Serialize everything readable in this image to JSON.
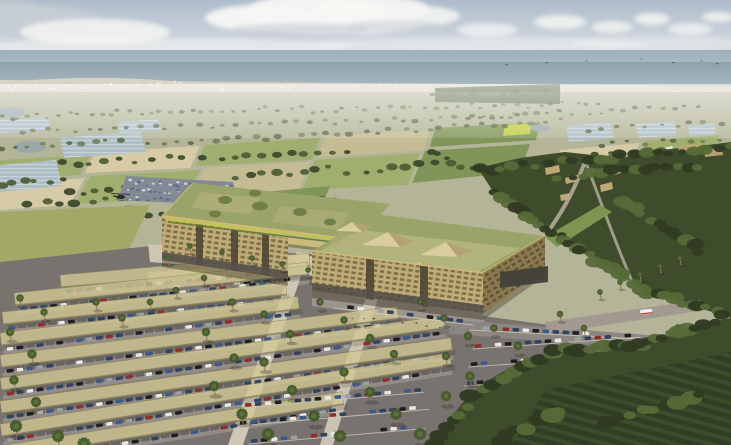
{
  "scene": {
    "type": "aerial-architectural-rendering",
    "description": "Bird's-eye rendering of a coastal campus: two long timber-screened buildings with green meadow roofs and glass pyramid skylights, a pergola-linked entrance plaza, fan-shaped solar-canopy parking lots filled with cars and palm trees, farmland patchwork with greenhouses and ponds, a village among dense trees, orchards in the foreground, a white coastal town strip and the sea under a hazy cloudy sky; a small helicopter flies over the fields.",
    "elements": [
      "sky-with-clouds",
      "sea-horizon",
      "ships",
      "coastal-town-strip",
      "farmland-patchwork",
      "greenhouses",
      "ponds",
      "distant-parking-lot",
      "helicopter",
      "village-in-trees",
      "right-forest",
      "main-building-left-wing",
      "main-building-right-wing",
      "green-roofs",
      "rooftop-trees",
      "skylight-pyramids",
      "entrance-pergola",
      "entrance-plaza",
      "solar-canopy-parking",
      "parked-cars",
      "open-parking-rows",
      "walkways",
      "access-roads",
      "truck",
      "palm-trees",
      "bottom-forest-orchard"
    ]
  },
  "colors": {
    "skyTop": "#aebccb",
    "skyMid": "#d7dce1",
    "skyHorizon": "#eef0ed",
    "cloudWhite": "#f7f7f4",
    "cloudGray": "#c7cdd4",
    "seaFar": "#7f96a4",
    "seaNear": "#aebcc3",
    "shipDark": "#5a6670",
    "coastStrip": "#d8d3c5",
    "coastCity": "#f2efe6",
    "plainBase": "#b4b598",
    "fieldTan": "#c8bd94",
    "fieldTanLight": "#d8cda6",
    "fieldGreen": "#9fae6d",
    "fieldGreenDark": "#7e9455",
    "fieldYellow": "#c3cf3e",
    "pond": "#9aa8a8",
    "greenhouse": "#aebfc6",
    "greenhouseRidge": "#e8eef0",
    "treeFar": "#6d7b52",
    "treeFarDark": "#556440",
    "treeMid": "#4c5b34",
    "treeMidDark": "#39462a",
    "forest": "#3f4c2c",
    "forestLight": "#566a38",
    "forestDark": "#2f3a22",
    "villageWall": "#c0a876",
    "facade": "#bda972",
    "facadeShade": "#9d8a5a",
    "windowDark": "#6d5f42",
    "recess": "#4e4634",
    "groundFloor": "#56514a",
    "fascia": "#cdb97a",
    "roofMeadow": "#9aa468",
    "roofMeadowLight": "#b5b07c",
    "roofTree": "#717f48",
    "flowerYellow": "#c5c44e",
    "flowerGreen": "#5f7a3c",
    "pyramidLight": "#d9cc9e",
    "pyramidShade": "#b5a273",
    "trellis": "#d8cf9e",
    "asphalt": "#797370",
    "aisle": "#8d8784",
    "stallConcrete": "#cfc8ba",
    "walkway": "#d8d0bd",
    "plaza": "#cfc6b2",
    "roadLight": "#a29a90",
    "canopy": "#d1c794",
    "canopyEdge": "#8f8660",
    "carNavy": "#31435f",
    "carBlue": "#3a5a8c",
    "carBlack": "#1d1f22",
    "carWhite": "#e8e8e6",
    "carSilver": "#9aa0a4",
    "carRed": "#8e2f2c",
    "carDotA": "#5a708f",
    "carDotB": "#d5d8da",
    "peopleDark": "#3a3f45",
    "palm": "#46592f",
    "palmLight": "#5c7038",
    "trunk": "#8a7a5e",
    "grassMeadow": "#a3a867",
    "berm": "#7f9450",
    "truckWhite": "#f1f0ec",
    "truckRed": "#b03a30",
    "heli": "#262a30"
  },
  "vegetation": {
    "tree_rows_far": [
      [
        0,
        118,
        130,
        112,
        14,
        2.2
      ],
      [
        140,
        114,
        300,
        108,
        16,
        2.2
      ],
      [
        310,
        111,
        470,
        105,
        15,
        2.2
      ],
      [
        480,
        107,
        600,
        103,
        11,
        2.2
      ],
      [
        575,
        112,
        700,
        108,
        11,
        2.2
      ],
      [
        20,
        131,
        180,
        126,
        13,
        2.6
      ],
      [
        200,
        127,
        360,
        121,
        14,
        2.6
      ],
      [
        380,
        120,
        520,
        115,
        12,
        2.6
      ],
      [
        470,
        117,
        560,
        112,
        9,
        2.6
      ],
      [
        590,
        129,
        720,
        123,
        10,
        2.6
      ],
      [
        600,
        144,
        720,
        139,
        9,
        2.8
      ],
      [
        0,
        147,
        120,
        141,
        10,
        3
      ],
      [
        150,
        144,
        280,
        137,
        11,
        3
      ],
      [
        300,
        134,
        430,
        129,
        11,
        3
      ],
      [
        440,
        127,
        560,
        121,
        10,
        2.8
      ],
      [
        435,
        96,
        555,
        91,
        14,
        3.2
      ]
    ],
    "tree_rows_mid": [
      [
        60,
        164,
        200,
        157,
        10,
        3.8
      ],
      [
        220,
        159,
        350,
        151,
        10,
        3.8
      ],
      [
        560,
        159,
        660,
        151,
        9,
        4
      ],
      [
        235,
        177,
        330,
        169,
        8,
        4.2
      ],
      [
        350,
        171,
        450,
        164,
        8,
        4.2
      ],
      [
        0,
        184,
        60,
        179,
        6,
        4.2
      ],
      [
        70,
        194,
        150,
        187,
        7,
        4.2
      ],
      [
        30,
        204,
        140,
        197,
        8,
        4.6
      ],
      [
        150,
        214,
        230,
        207,
        7,
        4.6
      ],
      [
        300,
        196,
        360,
        206,
        6,
        4.4
      ],
      [
        430,
        150,
        470,
        170,
        5,
        4
      ],
      [
        230,
        196,
        300,
        214,
        7,
        4.4
      ],
      [
        178,
        266,
        292,
        288,
        9,
        3.6
      ],
      [
        300,
        288,
        345,
        300,
        5,
        4
      ]
    ],
    "forest_blobs": [
      [
        478,
        170,
        731,
        146,
        22,
        6
      ],
      [
        492,
        192,
        560,
        236,
        12,
        6.5
      ],
      [
        560,
        238,
        648,
        292,
        13,
        7
      ],
      [
        648,
        292,
        724,
        314,
        10,
        7
      ],
      [
        560,
        176,
        700,
        166,
        14,
        6
      ],
      [
        620,
        200,
        700,
        250,
        12,
        7
      ],
      [
        470,
        398,
        556,
        352,
        12,
        7.5
      ],
      [
        556,
        350,
        640,
        344,
        11,
        8
      ],
      [
        640,
        342,
        712,
        324,
        10,
        8
      ],
      [
        436,
        442,
        468,
        408,
        6,
        8
      ],
      [
        500,
        440,
        560,
        410,
        8,
        9
      ],
      [
        606,
        420,
        700,
        396,
        9,
        8
      ]
    ]
  },
  "coast": {
    "city_dots": [
      [
        6,
        88,
        180,
        84,
        42,
        1.1
      ],
      [
        190,
        90,
        400,
        87,
        36,
        1.0
      ],
      [
        410,
        92,
        600,
        89,
        32,
        1.0
      ],
      [
        608,
        96,
        728,
        92,
        30,
        1.1
      ],
      [
        40,
        96,
        220,
        93,
        26,
        0.9
      ],
      [
        560,
        88,
        640,
        86,
        14,
        0.9
      ]
    ]
  },
  "parking": {
    "canopy_strips": [
      [
        148,
        272,
        150,
        -4
      ],
      [
        60,
        275,
        250,
        -5
      ],
      [
        14,
        293,
        295,
        -6
      ],
      [
        2,
        312,
        285,
        -6
      ],
      [
        0,
        333,
        300,
        -7
      ],
      [
        0,
        355,
        400,
        -7
      ],
      [
        0,
        378,
        448,
        -8
      ],
      [
        0,
        401,
        455,
        -8
      ],
      [
        0,
        424,
        455,
        -9
      ],
      [
        6,
        445,
        340,
        -9
      ]
    ],
    "open_rows": [
      [
        335,
        303,
        140,
        7
      ],
      [
        470,
        325,
        170,
        3
      ],
      [
        472,
        344,
        168,
        -4
      ],
      [
        468,
        362,
        176,
        -4
      ],
      [
        464,
        381,
        182,
        -4
      ],
      [
        470,
        400,
        150,
        -4
      ],
      [
        242,
        403,
        182,
        -5
      ],
      [
        237,
        421,
        192,
        -5
      ],
      [
        248,
        439,
        178,
        -5
      ]
    ],
    "car_cycle": [
      "carNavy",
      "carBlack",
      "carWhite",
      "carBlue",
      "carSilver",
      "carNavy",
      "carRed",
      "carNavy",
      "carWhite",
      "carBlack",
      "carBlue",
      "carNavy"
    ]
  },
  "distant_lot_rows": [
    [
      128,
      182,
      230,
      187,
      24,
      1.5
    ],
    [
      126,
      190,
      232,
      195,
      24,
      1.5
    ],
    [
      124,
      198,
      234,
      203,
      22,
      1.5
    ]
  ],
  "plaza_people": [
    [
      308,
      286,
      426,
      302,
      16,
      0.9
    ],
    [
      350,
      318,
      470,
      330,
      10,
      0.9
    ]
  ],
  "palms": [
    [
      20,
      298,
      4
    ],
    [
      44,
      312,
      4
    ],
    [
      10,
      332,
      4.5
    ],
    [
      32,
      354,
      5
    ],
    [
      14,
      380,
      5
    ],
    [
      36,
      402,
      5.5
    ],
    [
      16,
      426,
      6.5
    ],
    [
      58,
      436,
      6.5
    ],
    [
      84,
      444,
      7
    ],
    [
      96,
      302,
      4
    ],
    [
      122,
      318,
      4
    ],
    [
      150,
      302,
      3.5
    ],
    [
      176,
      290,
      3.5
    ],
    [
      204,
      278,
      3.5
    ],
    [
      206,
      332,
      4.5
    ],
    [
      232,
      302,
      4
    ],
    [
      234,
      358,
      5
    ],
    [
      214,
      386,
      5.5
    ],
    [
      242,
      414,
      6
    ],
    [
      268,
      434,
      6.5
    ],
    [
      264,
      314,
      4
    ],
    [
      290,
      334,
      4.5
    ],
    [
      264,
      362,
      5
    ],
    [
      292,
      390,
      5.5
    ],
    [
      314,
      416,
      6
    ],
    [
      340,
      436,
      6.5
    ],
    [
      320,
      302,
      4
    ],
    [
      344,
      320,
      4
    ],
    [
      370,
      338,
      4.5
    ],
    [
      394,
      354,
      4.5
    ],
    [
      344,
      372,
      5
    ],
    [
      370,
      392,
      5.5
    ],
    [
      396,
      414,
      6
    ],
    [
      420,
      434,
      6.5
    ],
    [
      420,
      302,
      3.5
    ],
    [
      444,
      318,
      4
    ],
    [
      468,
      336,
      4.5
    ],
    [
      446,
      356,
      4.5
    ],
    [
      470,
      376,
      5
    ],
    [
      494,
      396,
      5.5
    ],
    [
      446,
      396,
      5.5
    ],
    [
      494,
      328,
      4
    ],
    [
      518,
      346,
      4.5
    ],
    [
      542,
      362,
      4.5
    ],
    [
      518,
      384,
      5
    ],
    [
      560,
      314,
      3.5
    ],
    [
      584,
      328,
      3.5
    ],
    [
      606,
      344,
      4
    ],
    [
      630,
      358,
      4
    ],
    [
      584,
      354,
      4
    ],
    [
      654,
      342,
      4
    ],
    [
      678,
      328,
      4
    ],
    [
      702,
      346,
      4.5
    ],
    [
      600,
      292,
      3
    ],
    [
      620,
      282,
      3
    ],
    [
      640,
      274,
      3
    ],
    [
      660,
      266,
      3
    ],
    [
      680,
      258,
      3
    ],
    [
      704,
      374,
      5.5
    ],
    [
      726,
      392,
      6
    ],
    [
      702,
      414,
      6.5
    ],
    [
      726,
      432,
      7
    ],
    [
      168,
      258,
      3
    ],
    [
      190,
      246,
      3
    ],
    [
      222,
      252,
      3
    ],
    [
      252,
      258,
      3
    ],
    [
      282,
      264,
      3
    ],
    [
      308,
      270,
      3
    ]
  ],
  "ships": [
    [
      545,
      62
    ],
    [
      585,
      60
    ],
    [
      640,
      58
    ],
    [
      672,
      62
    ],
    [
      700,
      60
    ],
    [
      716,
      63
    ],
    [
      505,
      64
    ]
  ]
}
